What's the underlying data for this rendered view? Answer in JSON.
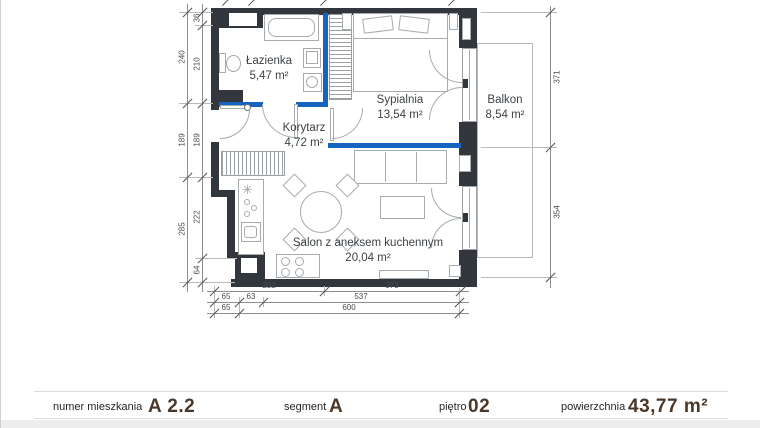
{
  "plan": {
    "rooms": {
      "lazienka": {
        "name": "Łazienka",
        "area": "5,47 m²"
      },
      "sypialnia": {
        "name": "Sypialnia",
        "area": "13,54 m²"
      },
      "korytarz": {
        "name": "Korytarz",
        "area": "4,72 m²"
      },
      "salon": {
        "name": "Salon z aneksem kuchennym",
        "area": "20,04 m²"
      },
      "balkon": {
        "name": "Balkon",
        "area": "8,54 m²"
      }
    },
    "dimensions": {
      "left_outer": [
        "240",
        "189",
        "285"
      ],
      "left_inner": [
        "36",
        "210",
        "189",
        "222",
        "64"
      ],
      "right": [
        "371",
        "354"
      ],
      "bottom_row1": [
        "292",
        "373"
      ],
      "bottom_row2": [
        "65",
        "63",
        "537"
      ],
      "bottom_row3": [
        "65",
        "600"
      ]
    },
    "symbols": {
      "kitchen_star": "✳"
    },
    "colors": {
      "wall": "#31373c",
      "highlight_wall": "#1565c0"
    }
  },
  "footer": {
    "items": [
      {
        "label": "numer mieszkania",
        "value": "A 2.2"
      },
      {
        "label": "segment",
        "value": "A"
      },
      {
        "label": "piętro",
        "value": "02"
      },
      {
        "label": "powierzchnia",
        "value": "43,77 m²"
      }
    ]
  }
}
